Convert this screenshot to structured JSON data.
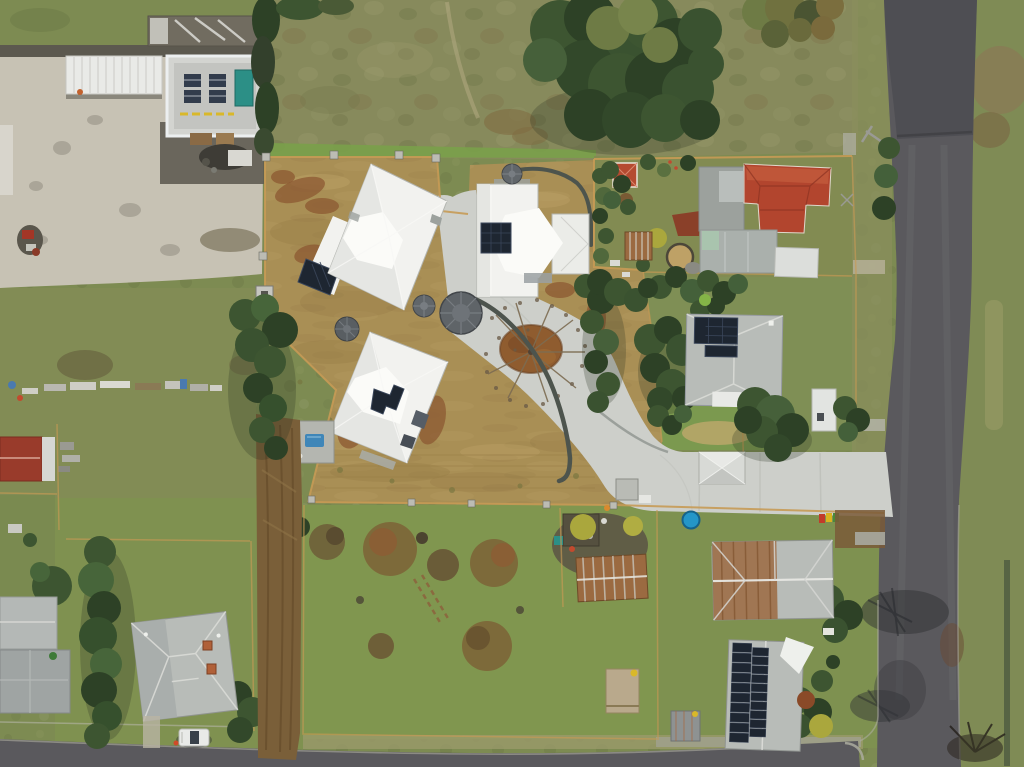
{
  "scene": {
    "type": "aerial-drone-photograph",
    "description": "Top-down drone view of a semi-rural residential block: a new development lot with three white-roofed homes, curved concrete driveway and water tanks, surrounded by neighbouring houses, green paddocks, hedges and two asphalt roads.",
    "no_visible_text": true,
    "objects": [
      "vertical-road",
      "bottom-road",
      "industrial-yard",
      "warehouse-roof",
      "carport-canopy",
      "development-lot",
      "house-a",
      "house-b",
      "house-c",
      "garage-studio",
      "water-tanks",
      "circular-garden-bed",
      "bare-tree",
      "curved-retaining-walls",
      "swimming-pool",
      "red-roof-house",
      "cubby-house",
      "gray-roof-house",
      "garden-shed",
      "rusty-roof-house",
      "solar-roof-house",
      "hip-roof-house",
      "hedgerow",
      "paddock-junk",
      "dirt-track",
      "parked-ute",
      "trampoline",
      "wheelie-bins",
      "shade-sail",
      "sand-pit"
    ]
  },
  "palette": {
    "grass_base": "#7d8b52",
    "grass_soft": "#80964f",
    "grass_bright": "#7aa04a",
    "grass_pale": "#9fa06a",
    "grass_dry": "#8a8f5c",
    "tree_dark": "#3d5531",
    "tree_deep": "#2d4126",
    "tree_olive": "#6e7b45",
    "tree_brown": "#7b6e3e",
    "scrub": "#878a5c",
    "trail": "#b2aa82",
    "dirt": "#a98f55",
    "dirt_dark": "#8f7440",
    "dirt_light": "#c3aa6e",
    "rust": "#8a5630",
    "island": "#8f5c2f",
    "fence": "#c79a55",
    "concrete": "#cdcfca",
    "concrete_dim": "#bdbfb9",
    "yard": "#c7c2b4",
    "gravel": "#5c594f",
    "asphalt": "#5a595d",
    "asphalt_light": "#6e6d71",
    "asphalt_dark": "#45454a",
    "curb": "#abab9f",
    "roof_white": "#f2f2ef",
    "roof_shade": "#e3e4e0",
    "roof_bright": "#fbfbf8",
    "roof_gray": "#b8bcb8",
    "roof_gray2": "#9ca19d",
    "roof_red": "#b2452e",
    "roof_red_light": "#c25a3c",
    "red_dark": "#8c3322",
    "roof_rust": "#9b6a41",
    "solar": "#1e2631",
    "solar_line": "#3a465a",
    "tank": "#61666a",
    "wall": "#4d544d",
    "pool": "#3f86b8",
    "tramp": "#2496c8",
    "teal": "#2c8f86",
    "yellow": "#d9b82a",
    "yellowgreen": "#aaa73d",
    "sand": "#c2a368",
    "mint": "#a9c4ae",
    "car_white": "#e9eae8",
    "bin_red": "#c23b2a",
    "bin_yellow": "#d9b31f",
    "bin_green": "#4a8a3a"
  }
}
